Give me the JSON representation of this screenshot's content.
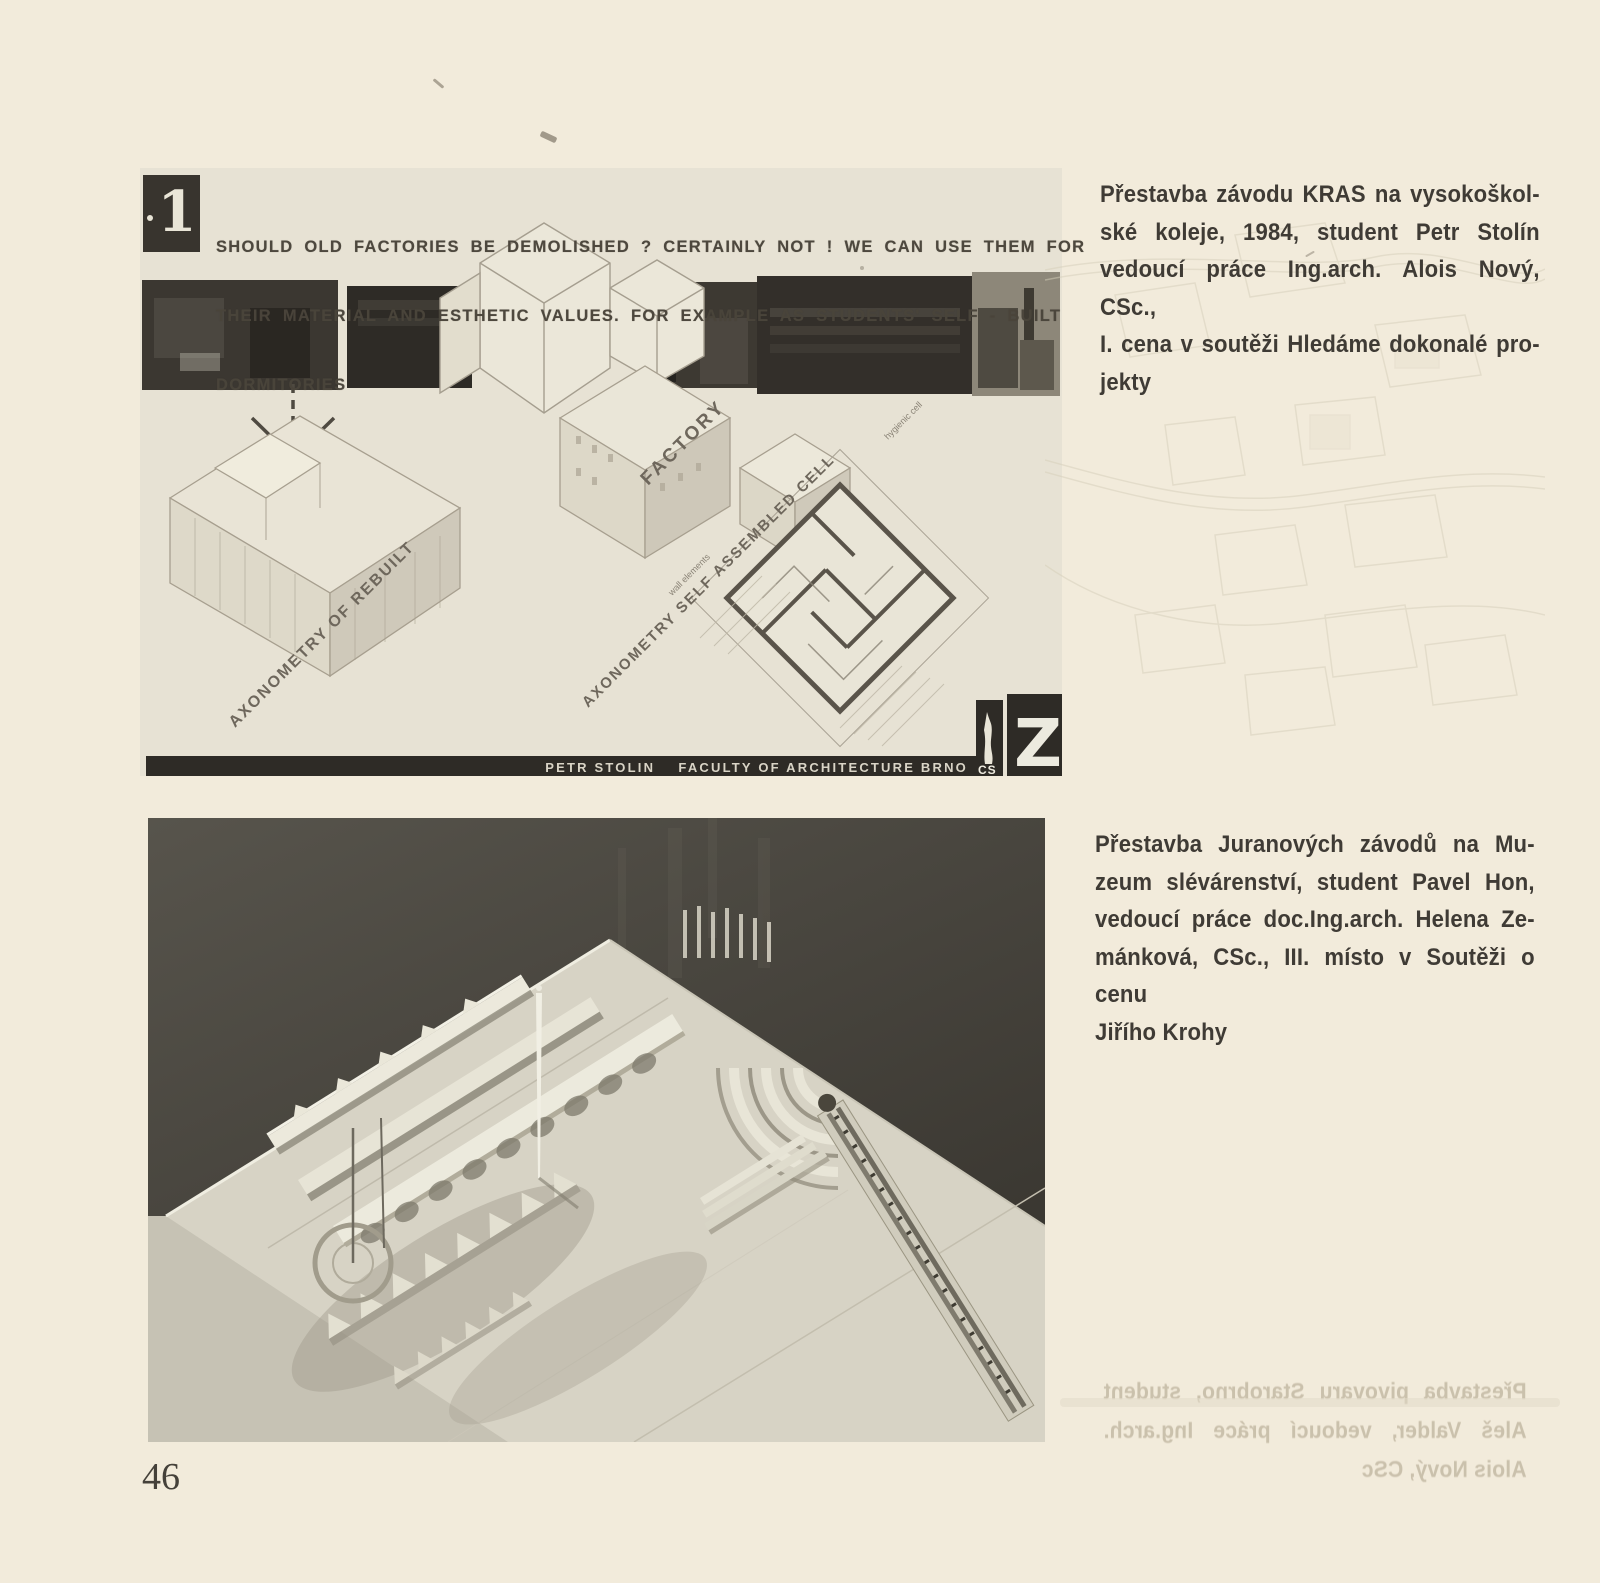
{
  "page": {
    "number": "46"
  },
  "top_panel": {
    "plate_number": "1",
    "headline_lines": [
      "SHOULD OLD FACTORIES BE DEMOLISHED ? CERTAINLY NOT ! WE CAN USE THEM FOR",
      "THEIR MATERIAL AND ESTHETIC VALUES. FOR EXAMPLE AS STUDENTS' SELF - BUILT",
      "DORMITORIES"
    ],
    "labels": {
      "axo_rebuilt": "AXONOMETRY OF REBUILT",
      "factory": "FACTORY",
      "axo_cell": "AXONOMETRY  SELF ASSEMBLED CELL",
      "wall_elements": "wall elements",
      "hygienic_cell": "hygienic cell"
    },
    "footer_text": "PETR STOLIN    FACULTY OF ARCHITECTURE BRNO",
    "footer_cs": "CS",
    "logo_letter": "Z"
  },
  "captions": {
    "top_lines": [
      "Přestavba závodu KRAS na vysokoškol-",
      "ské koleje, 1984, student Petr Stolín",
      "vedoucí práce Ing.arch. Alois Nový, CSc.,",
      "I. cena v soutěži Hledáme dokonalé pro-",
      "jekty"
    ],
    "bottom_lines": [
      "Přestavba Juranových závodů na Mu-",
      "zeum slévárenství, student Pavel Hon,",
      "vedoucí práce doc.Ing.arch. Helena Ze-",
      "mánková, CSc., III. místo v Soutěži o cenu",
      "Jiřího Krohy"
    ],
    "bleed_lines": [
      "Přestavba pivovaru Starobrno, student",
      "Aleš Valder, vedoucí práce Ing.arch.",
      "Alois Nový, CSc"
    ]
  }
}
